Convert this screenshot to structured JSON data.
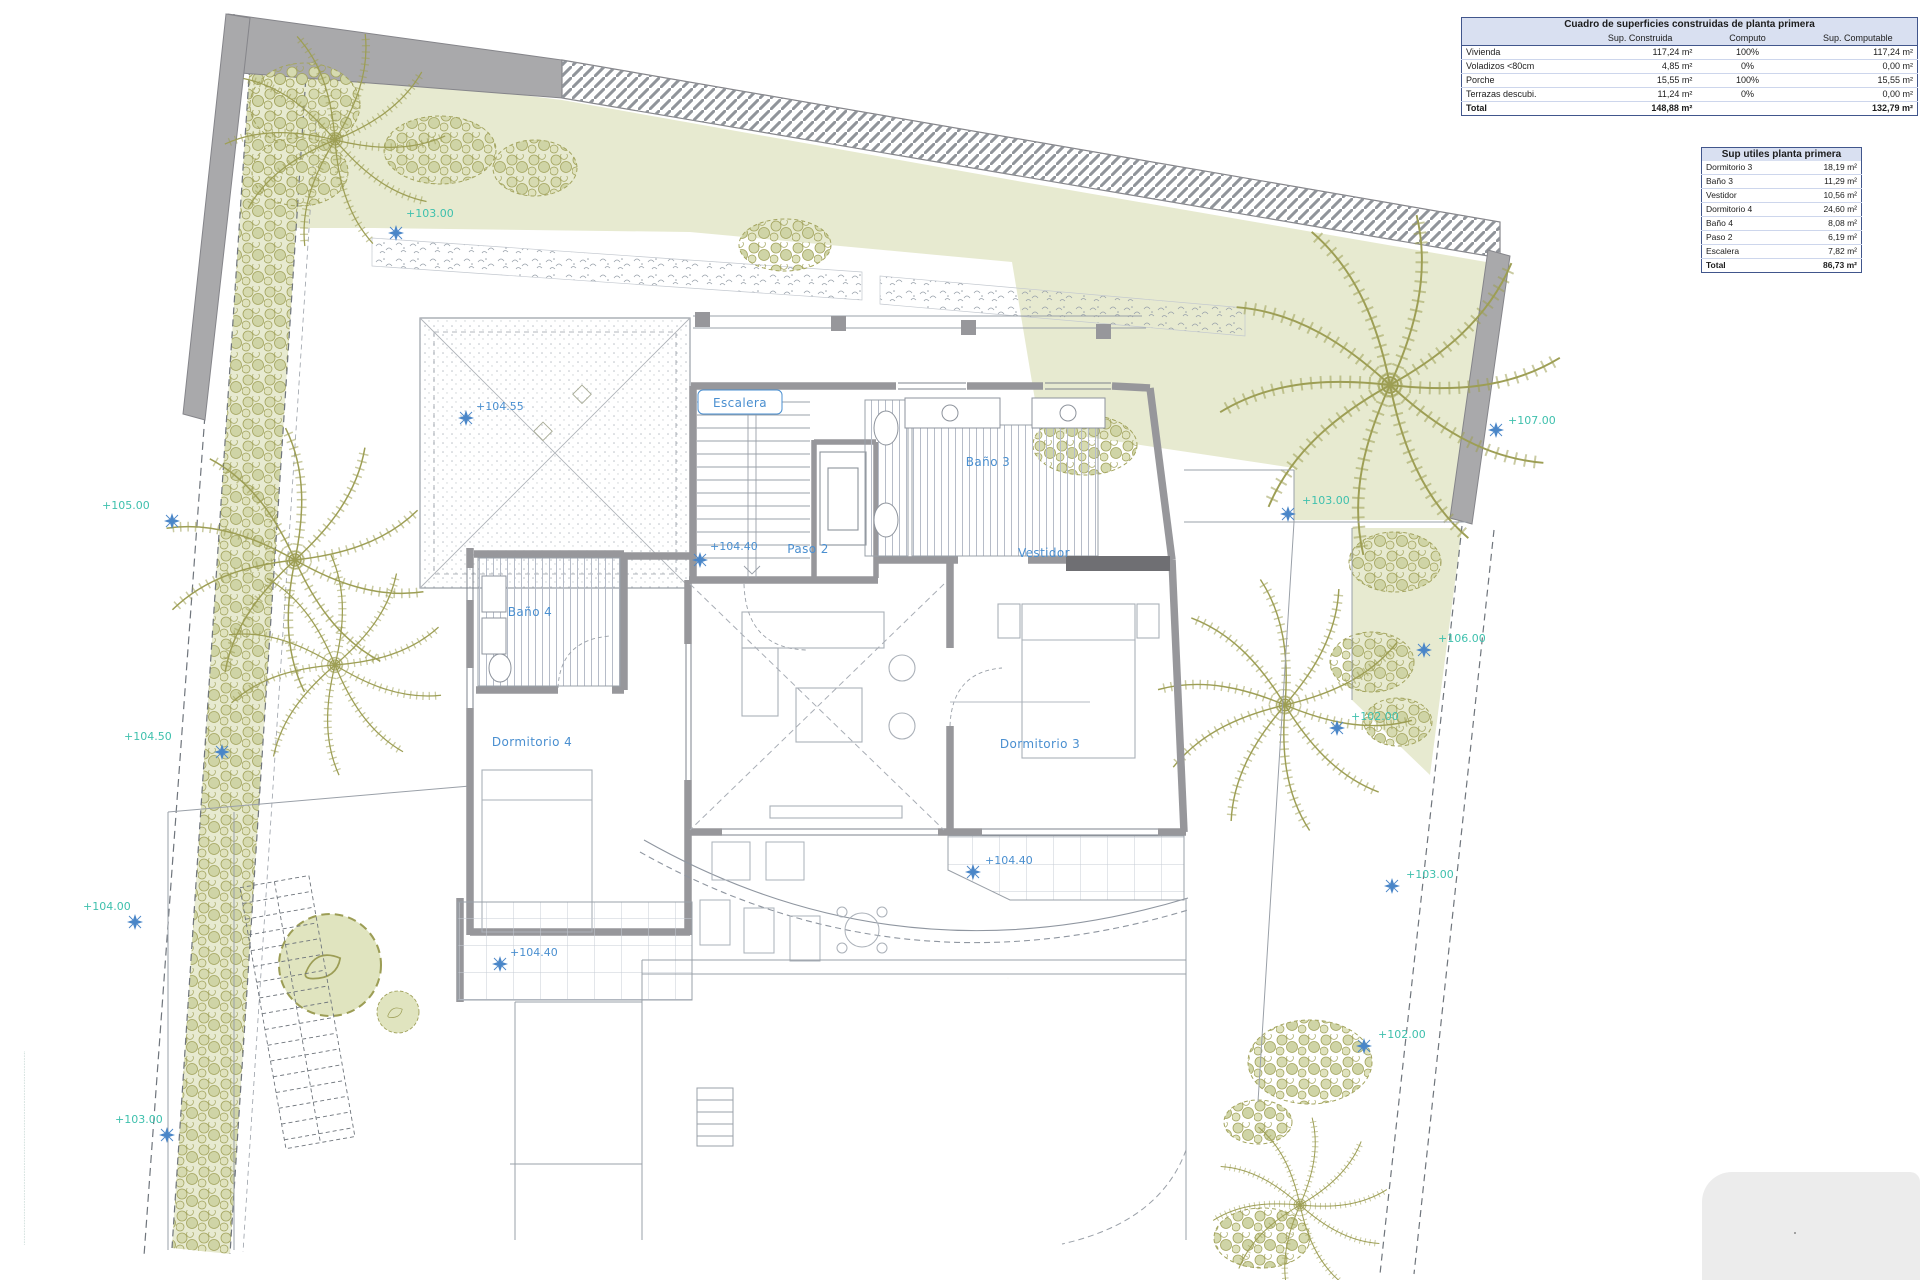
{
  "colors": {
    "accent_blue": "#4a8fd0",
    "accent_teal": "#3fc0ad",
    "wall_gray": "#97979b",
    "garden_green": "#e7ead0",
    "olive": "#a3a45e",
    "table_header_fill": "#d9e0f1",
    "table_border_navy": "#41568c"
  },
  "tables": {
    "constructed": {
      "title": "Cuadro de superficies construidas de planta primera",
      "col_headers": [
        "",
        "Sup. Construida",
        "Computo",
        "Sup. Computable"
      ],
      "rows": [
        {
          "name": "Vivienda",
          "sup": "117,24 m²",
          "comp": "100%",
          "computable": "117,24 m²"
        },
        {
          "name": "Voladizos <80cm",
          "sup": "4,85 m²",
          "comp": "0%",
          "computable": "0,00 m²"
        },
        {
          "name": "Porche",
          "sup": "15,55 m²",
          "comp": "100%",
          "computable": "15,55 m²"
        },
        {
          "name": "Terrazas descubi.",
          "sup": "11,24 m²",
          "comp": "0%",
          "computable": "0,00 m²"
        }
      ],
      "total": {
        "name": "Total",
        "sup": "148,88 m²",
        "comp": "",
        "computable": "132,79 m²"
      }
    },
    "useful": {
      "title": "Sup utiles planta primera",
      "rows": [
        {
          "name": "Dormitorio 3",
          "value": "18,19 m²"
        },
        {
          "name": "Baño 3",
          "value": "11,29 m²"
        },
        {
          "name": "Vestidor",
          "value": "10,56 m²"
        },
        {
          "name": "Dormitorio 4",
          "value": "24,60 m²"
        },
        {
          "name": "Baño 4",
          "value": "8,08 m²"
        },
        {
          "name": "Paso 2",
          "value": "6,19 m²"
        },
        {
          "name": "Escalera",
          "value": "7,82 m²"
        }
      ],
      "total": {
        "name": "Total",
        "value": "86,73 m²"
      }
    }
  },
  "plan": {
    "rooms": {
      "escalera": "Escalera",
      "bano3": "Baño 3",
      "vestidor": "Vestidor",
      "paso2": "Paso 2",
      "bano4": "Baño 4",
      "dormitorio4": "Dormitorio 4",
      "dormitorio3": "Dormitorio 3"
    },
    "site_levels": [
      "+103.00",
      "+105.00",
      "+104.50",
      "+104.00",
      "+103.00",
      "+107.00",
      "+103.00",
      "+106.00",
      "+102.00",
      "+103.00",
      "+102.00"
    ],
    "floor_levels": [
      "+104.55",
      "+104.40",
      "+104.40",
      "+104.40"
    ],
    "edge_microtext": "··························································································································"
  }
}
